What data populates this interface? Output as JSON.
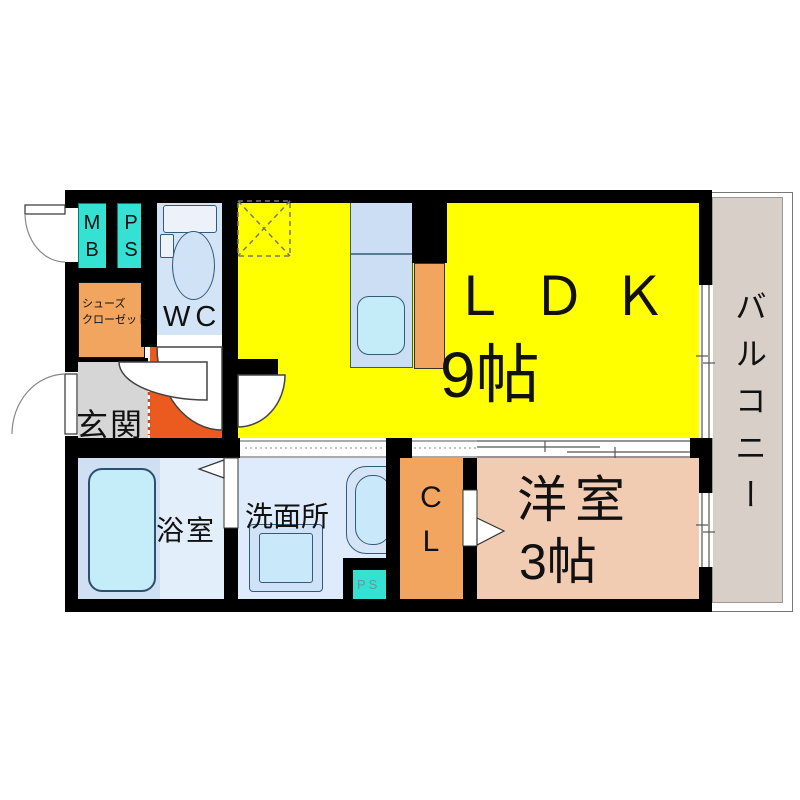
{
  "plan": {
    "type": "floor-plan",
    "rooms": {
      "ldk": {
        "name": "ＬＤＫ",
        "size": "9帖"
      },
      "western_room": {
        "name": "洋室",
        "size": "3帖"
      },
      "balcony": {
        "name": "バルコニー"
      },
      "bathroom": {
        "name": "浴室"
      },
      "washroom": {
        "name": "洗面所"
      },
      "entrance": {
        "name": "玄関"
      },
      "toilet": {
        "name": "WC"
      },
      "closet": {
        "name": "CL"
      },
      "shoe_closet": {
        "line1": "シューズ",
        "line2": "クローゼット"
      },
      "meter_box": {
        "name": "MB"
      },
      "pipe_space": {
        "name": "PS"
      },
      "pipe_space_small": {
        "name": "PS"
      }
    },
    "colors": {
      "wall": "#000000",
      "ldk_fill": "#FFFF00",
      "balcony_fill": "#D8CFC8",
      "western_room_fill": "#F1CCB2",
      "closet_fill": "#F1A55E",
      "shoe_closet_fill": "#F1A55E",
      "hall_fill": "#EB5A1F",
      "entrance_fill": "#D6D6D6",
      "meter_pipe_fill": "#35E1D2",
      "toilet_room_fill": "#D3E4F7",
      "bathroom_fill": "#E3EEFB",
      "washroom_fill": "#DDEBFC",
      "kitchen_fill": "#CBDEF3",
      "fixture_fill": "#C5ECF9",
      "step_line": "#D74A1E"
    }
  }
}
